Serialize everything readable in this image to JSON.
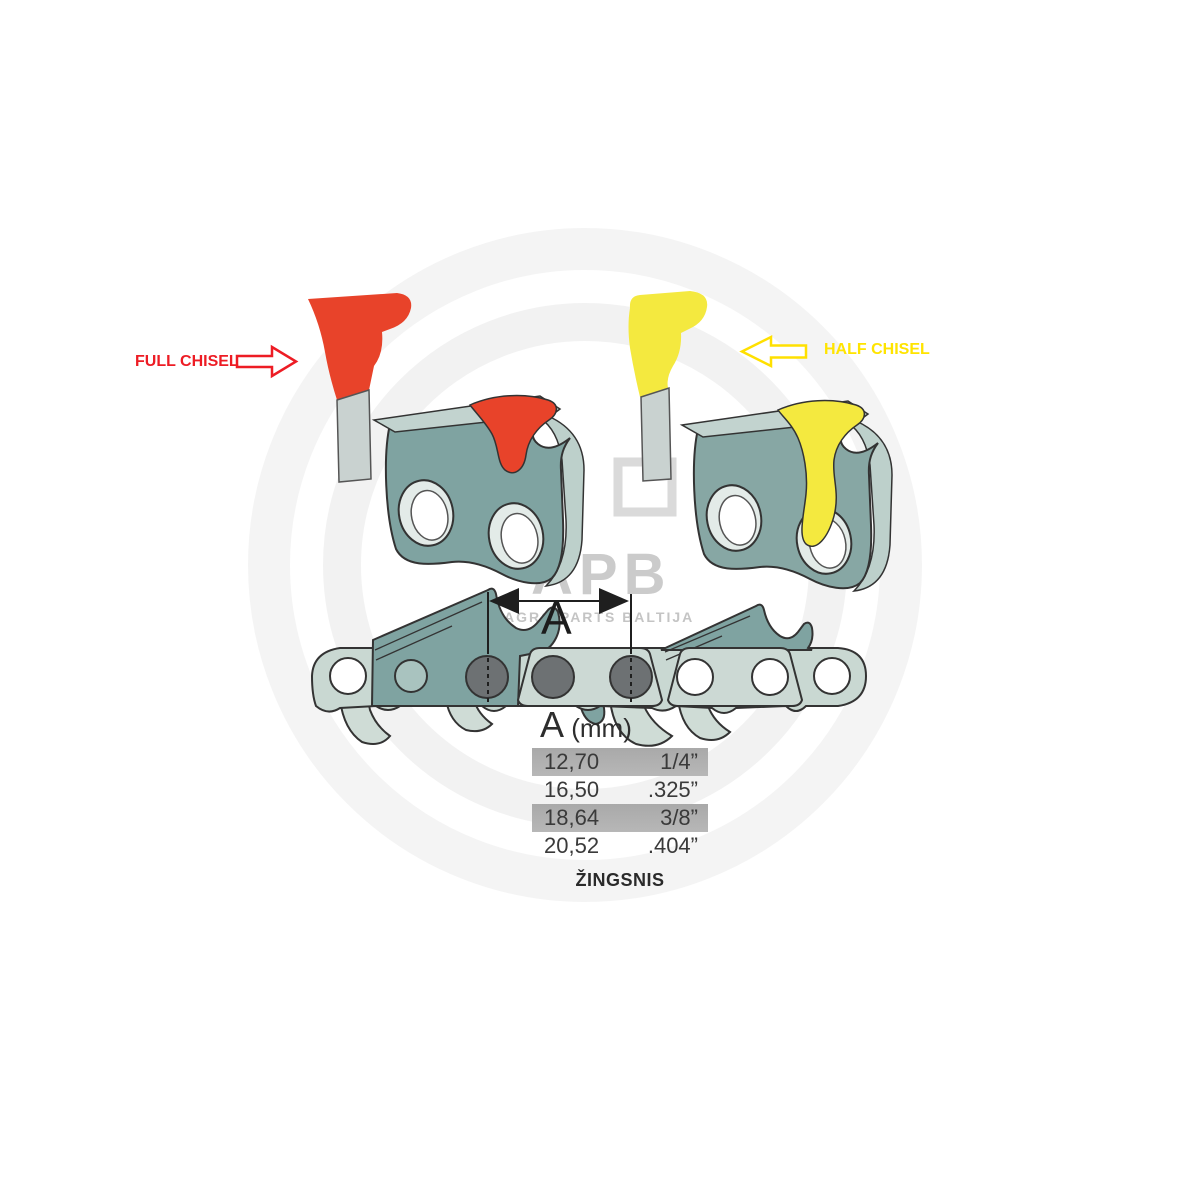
{
  "annotations": {
    "full_chisel_label": "FULL CHISEL",
    "half_chisel_label": "HALF CHISEL",
    "dimension_label": "A"
  },
  "watermark": {
    "abbr": "APB",
    "name": "AGRO PARTS BALTIJA"
  },
  "pitch_table": {
    "header": {
      "letter": "A",
      "unit": " (mm)"
    },
    "rows": [
      {
        "mm": "12,70",
        "inch": "1/4”",
        "highlighted": true
      },
      {
        "mm": "16,50",
        "inch": ".325”",
        "highlighted": false
      },
      {
        "mm": "18,64",
        "inch": "3/8”",
        "highlighted": true
      },
      {
        "mm": "20,52",
        "inch": ".404”",
        "highlighted": false
      }
    ],
    "caption": "ŽINGSNIS"
  },
  "chart_data": {
    "type": "table",
    "title": "A (mm)",
    "columns": [
      "A (mm)",
      "inches"
    ],
    "rows": [
      [
        "12,70",
        "1/4”"
      ],
      [
        "16,50",
        ".325”"
      ],
      [
        "18,64",
        "3/8”"
      ],
      [
        "20,52",
        ".404”"
      ]
    ],
    "caption": "ŽINGSNIS",
    "highlighted_rows": [
      0,
      2
    ]
  },
  "colors": {
    "full_chisel_red": "#e8432a",
    "full_chisel_label_red": "#ed1c24",
    "half_chisel_yellow": "#f4e93f",
    "half_chisel_label_yellow": "#ffe400",
    "cutter_body_teal": "#7fa3a1",
    "link_light_sage": "#c9d8d2",
    "top_plate_light": "#c2d3cf",
    "rivet_gray": "#6d7173",
    "row_highlight_gray": "#b1b1b1",
    "watermark_gray": "#cbcbcb"
  }
}
